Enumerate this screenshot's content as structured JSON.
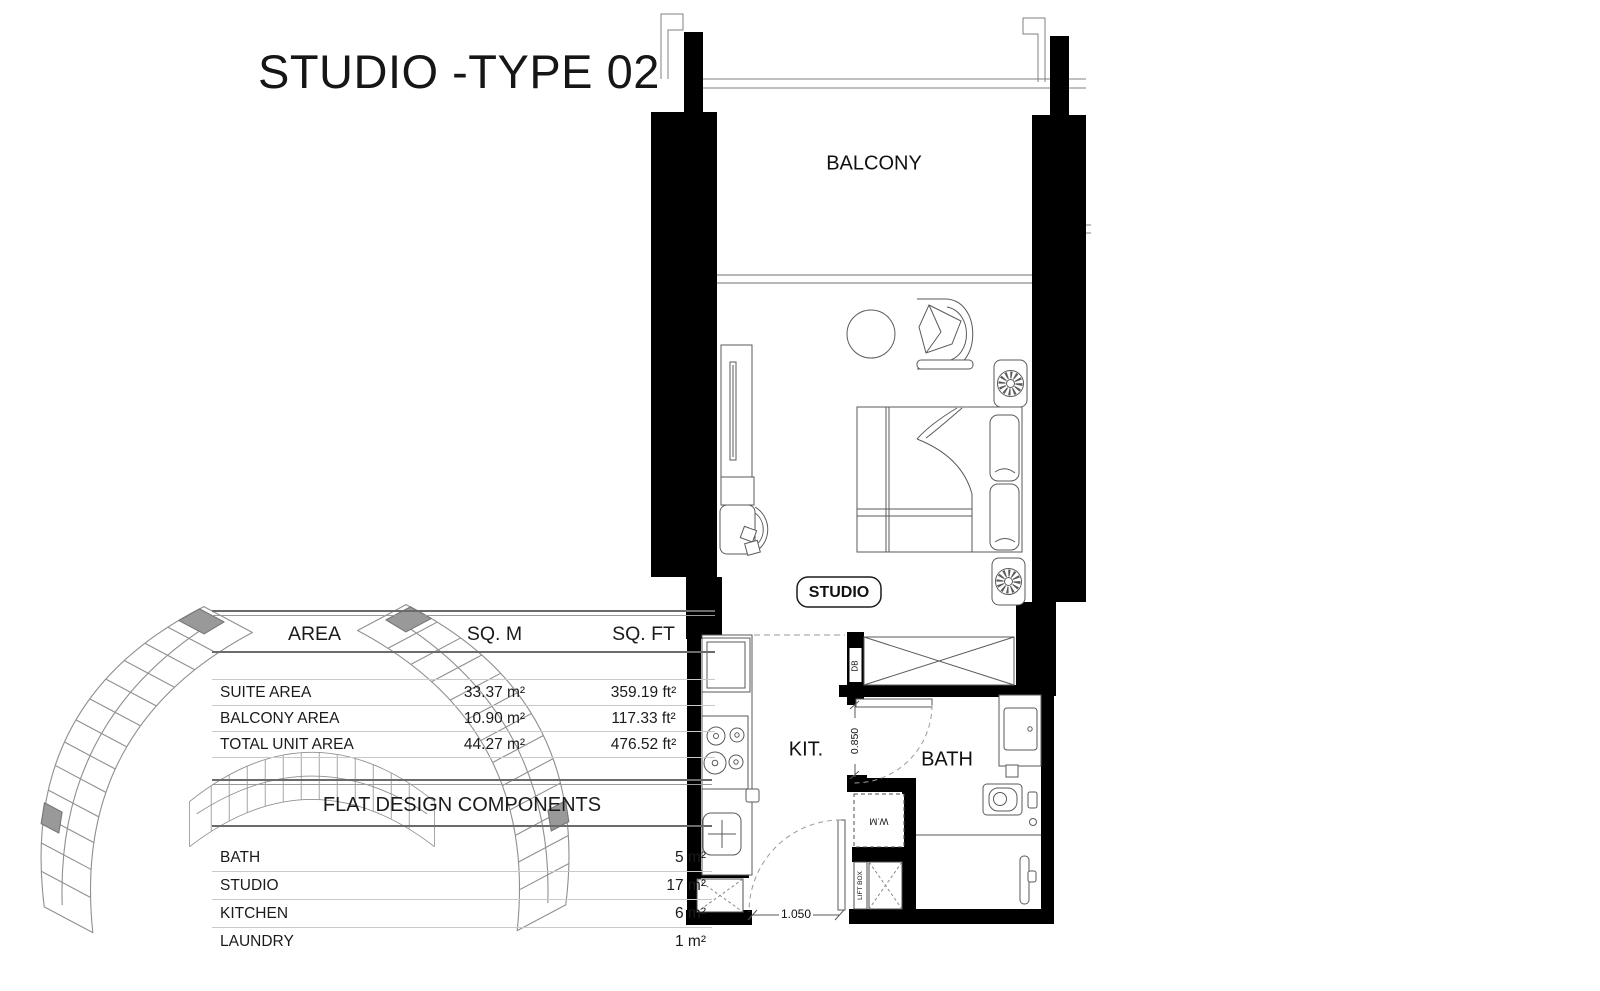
{
  "title": "STUDIO -TYPE 02",
  "area_table": {
    "headers": [
      "AREA",
      "SQ. M",
      "SQ. FT"
    ],
    "rows": [
      {
        "label": "SUITE AREA",
        "sqm": "33.37 m²",
        "sqft": "359.19 ft²"
      },
      {
        "label": "BALCONY AREA",
        "sqm": "10.90 m²",
        "sqft": "117.33 ft²"
      },
      {
        "label": "TOTAL UNIT AREA",
        "sqm": "44.27 m²",
        "sqft": "476.52 ft²"
      }
    ]
  },
  "components_table": {
    "title": "FLAT DESIGN COMPONENTS",
    "rows": [
      {
        "label": "BATH",
        "value": "5 m²"
      },
      {
        "label": "STUDIO",
        "value": "17 m²"
      },
      {
        "label": "KITCHEN",
        "value": "6 m²"
      },
      {
        "label": "LAUNDRY",
        "value": "1 m²"
      }
    ]
  },
  "floor_plan": {
    "room_labels": {
      "balcony": "BALCONY",
      "studio": "STUDIO",
      "kitchen": "KIT.",
      "bath": "BATH"
    },
    "equipment_labels": {
      "db": "DB",
      "wm": "W.M",
      "lift_box": "LIFT BOX"
    },
    "dimensions": {
      "bath_door": "0.850",
      "entry_door": "1.050"
    }
  },
  "colors": {
    "wall": "#000000",
    "drawing_line": "#5a5a5a",
    "key_plan_highlight": "#999999"
  }
}
